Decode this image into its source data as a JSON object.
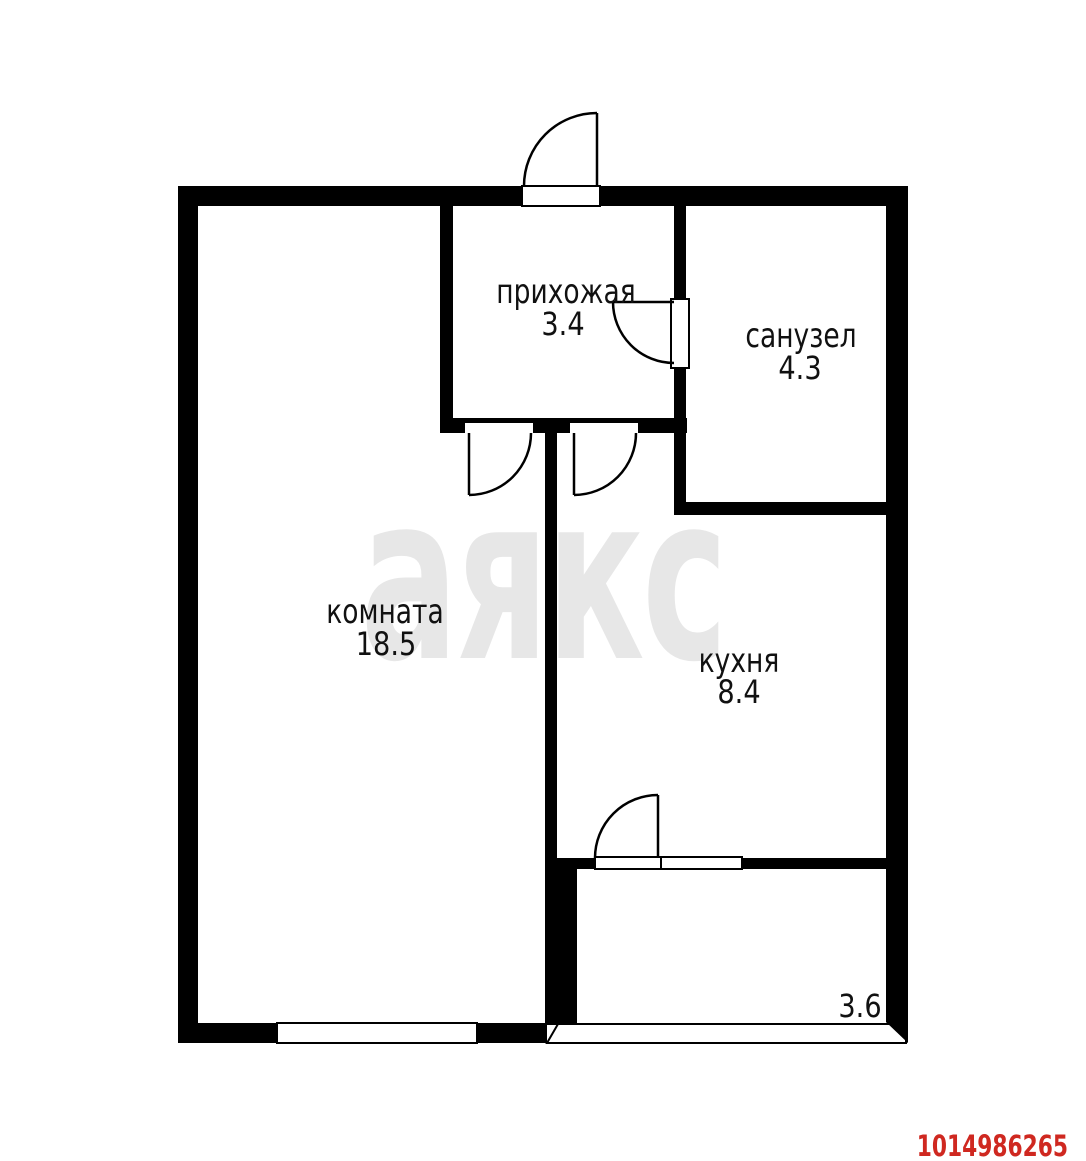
{
  "rooms": {
    "hallway": {
      "label": "прихожая",
      "area": "3.4"
    },
    "bathroom": {
      "label": "санузел",
      "area": "4.3"
    },
    "living_room": {
      "label": "комната",
      "area": "18.5"
    },
    "kitchen": {
      "label": "кухня",
      "area": "8.4"
    },
    "balcony": {
      "area": "3.6"
    }
  },
  "watermark": {
    "text": "аякс",
    "color": "#e7e7e7"
  },
  "listing_id": {
    "value": "1014986265",
    "color": "#cf2820"
  },
  "colors": {
    "background": "#ffffff",
    "walls": "#000000",
    "labels": "#111111"
  }
}
